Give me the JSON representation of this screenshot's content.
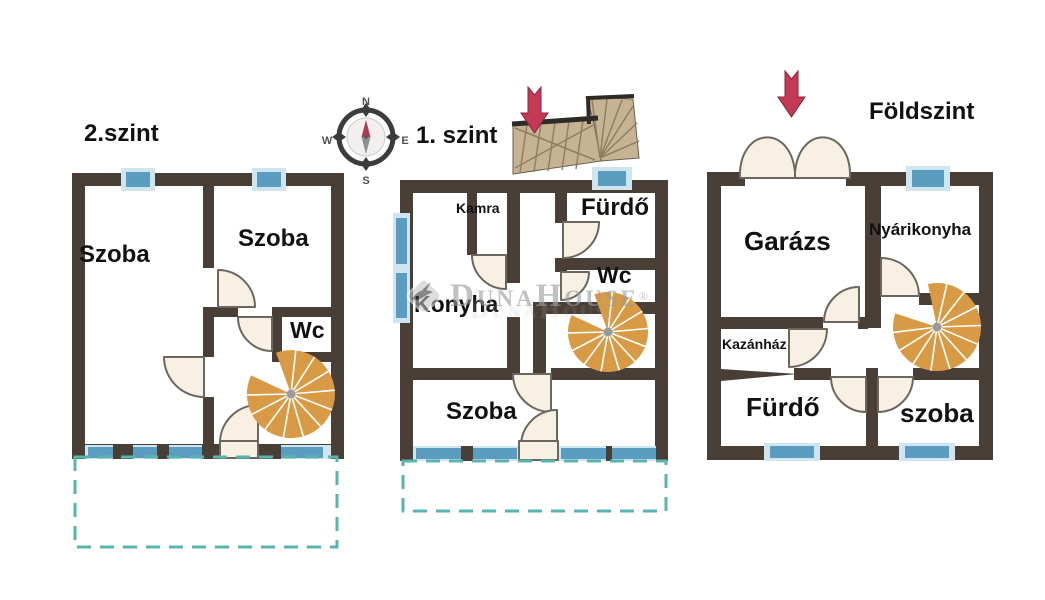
{
  "floors": [
    {
      "id": "second-floor",
      "title": "2.szint",
      "rooms": [
        {
          "label": "Szoba"
        },
        {
          "label": "Szoba"
        },
        {
          "label": "Wc"
        }
      ]
    },
    {
      "id": "first-floor",
      "title": "1. szint",
      "rooms": [
        {
          "label": "Kamra"
        },
        {
          "label": "Fürdő"
        },
        {
          "label": "Wc"
        },
        {
          "label": "Konyha"
        },
        {
          "label": "Szoba"
        }
      ]
    },
    {
      "id": "ground-floor",
      "title": "Földszint",
      "rooms": [
        {
          "label": "Garázs"
        },
        {
          "label": "Nyárikonyha"
        },
        {
          "label": "Kazánház"
        },
        {
          "label": "Fürdő"
        },
        {
          "label": "szoba"
        }
      ]
    }
  ],
  "compass": {
    "north": "N",
    "east": "E",
    "south": "S",
    "west": "W"
  },
  "watermark": {
    "text": "DunaHouse",
    "registered": "®"
  },
  "colors": {
    "wall": "#4a3f36",
    "window_frame": "#cfe6f0",
    "window_glass": "#5b9dc1",
    "door_fill": "#f7f0e3",
    "door_stroke": "#6b675f",
    "stair_orange": "#d89a44",
    "stair_tan": "#c6b394",
    "stair_shade": "#8f7f63",
    "stair_rail": "#2e2a25",
    "arrow_red": "#c23a55",
    "arrow_edge": "#8e2238",
    "terrace_teal": "#58b4ae",
    "watermark_gray": "#999da2",
    "text_black": "#111111"
  }
}
